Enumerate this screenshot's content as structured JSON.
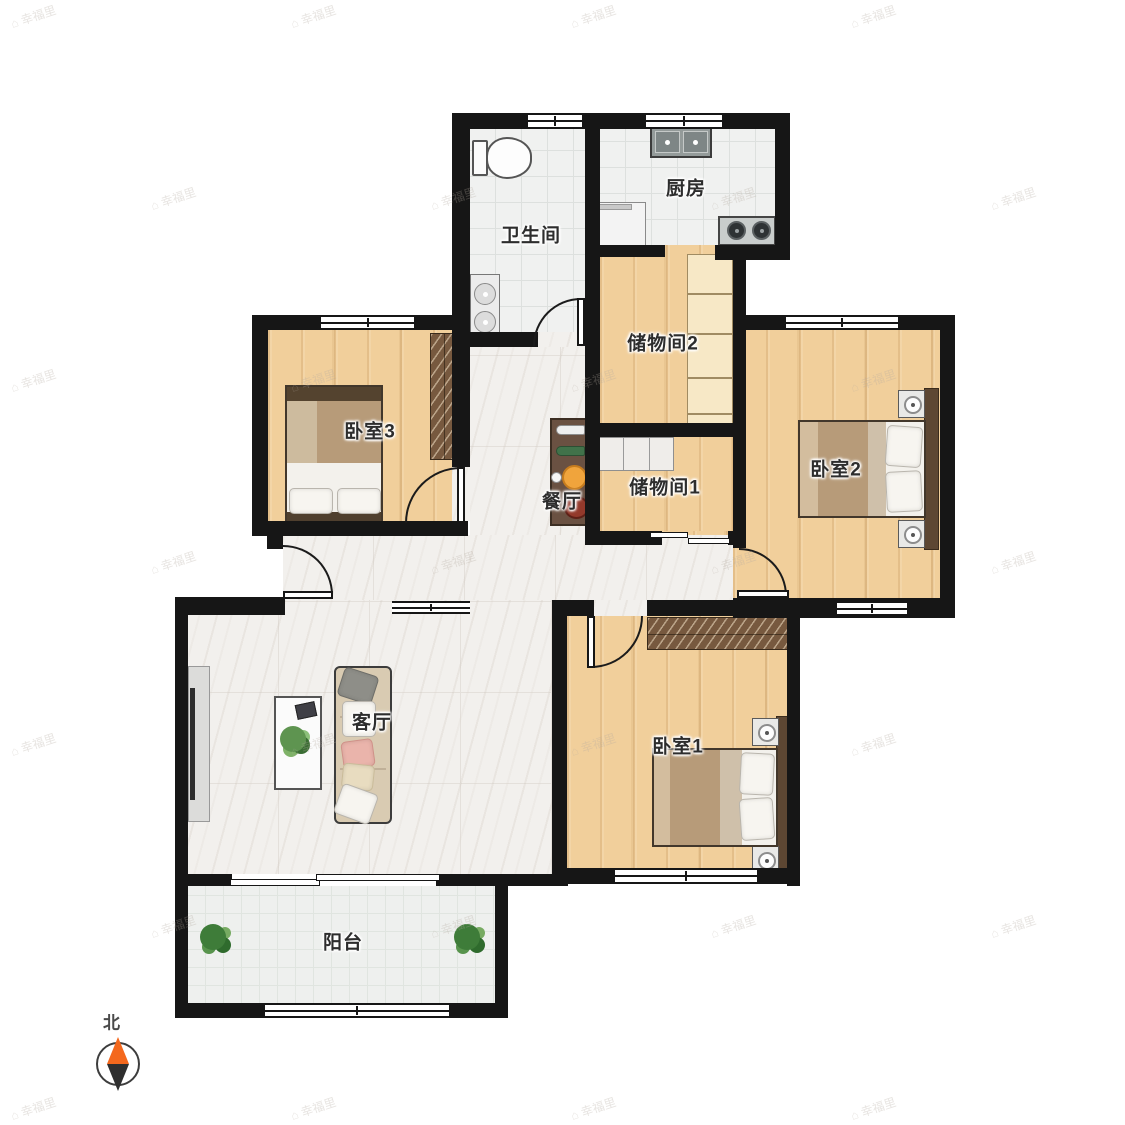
{
  "plan": {
    "title": "apartment-floor-plan",
    "rooms": [
      {
        "id": "bathroom",
        "label": "卫生间"
      },
      {
        "id": "kitchen",
        "label": "厨房"
      },
      {
        "id": "storage2",
        "label": "储物间2"
      },
      {
        "id": "storage1",
        "label": "储物间1"
      },
      {
        "id": "bedroom3",
        "label": "卧室3"
      },
      {
        "id": "bedroom2",
        "label": "卧室2"
      },
      {
        "id": "bedroom1",
        "label": "卧室1"
      },
      {
        "id": "dining",
        "label": "餐厅"
      },
      {
        "id": "living",
        "label": "客厅"
      },
      {
        "id": "balcony",
        "label": "阳台"
      }
    ],
    "compass": {
      "label": "北"
    },
    "watermark": {
      "icon": "⌂",
      "text": "幸福里"
    },
    "colors": {
      "wall": "#161616",
      "wood_floor": "#f1cf9b",
      "tile_floor": "#f0f1f0",
      "marble_floor": "#f2f0ed",
      "wardrobe": "#77593f",
      "compass_north": "#f4681d",
      "compass_south": "#2f2f2f",
      "plant_green": "#3e7c39"
    }
  }
}
